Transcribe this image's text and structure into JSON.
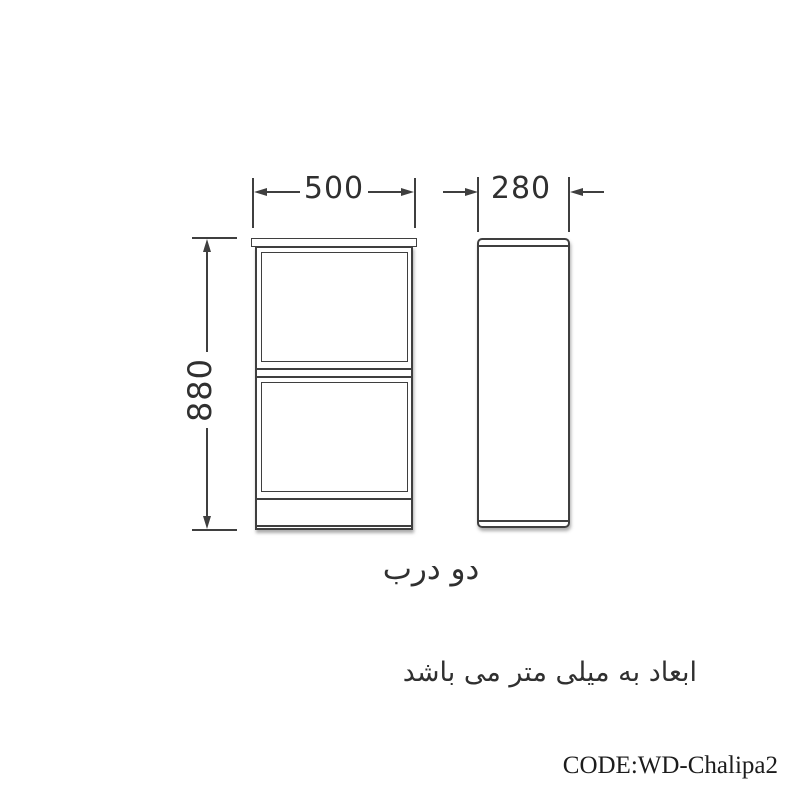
{
  "page": {
    "background": "#ffffff"
  },
  "drawing": {
    "line_color": "#3f3f3f",
    "text_color": "#303030",
    "dimensions": {
      "width_mm": "500",
      "depth_mm": "280",
      "height_mm": "880"
    },
    "caption": "دو درب",
    "note": "ابعاد به میلی متر می باشد",
    "code": "CODE:WD-Chalipa2"
  }
}
